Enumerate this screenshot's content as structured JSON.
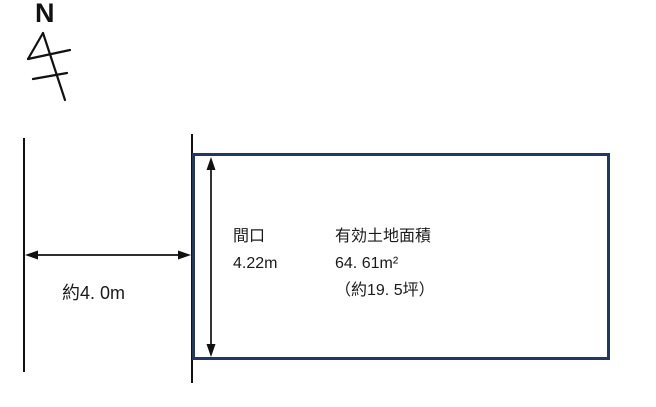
{
  "north": {
    "label": "N"
  },
  "road": {
    "width_label": "約4. 0m"
  },
  "frontage": {
    "label": "間口",
    "value": "4.22m"
  },
  "area": {
    "title": "有効土地面積",
    "sqm": "64. 61m²",
    "tsubo": "（約19. 5坪）"
  },
  "colors": {
    "plot_border": "#1f3864",
    "ink": "#1a1a1a"
  }
}
